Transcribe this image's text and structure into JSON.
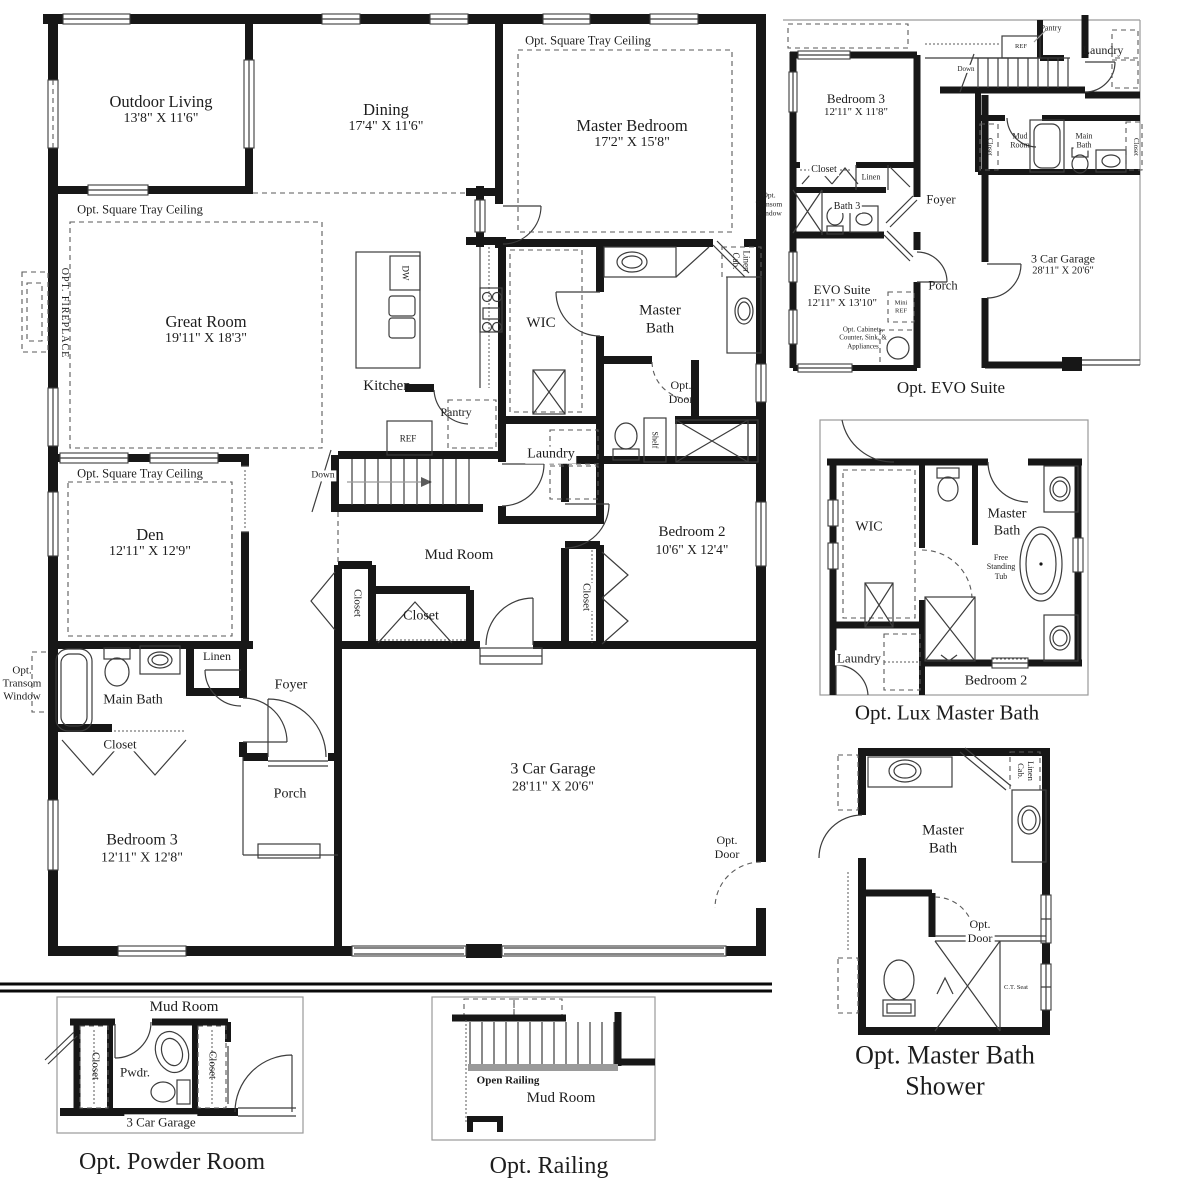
{
  "shared": {
    "closet": "Closet",
    "linen": "Linen",
    "linen_cab": "Linen\nCab.",
    "laundry": "Laundry",
    "mud_room": "Mud Room",
    "mud_room_2l": "Mud\nRoom",
    "main_bath": "Main Bath",
    "main_bath_2l": "Main\nBath",
    "master_bath_2l": "Master\nBath",
    "wic": "WIC",
    "foyer": "Foyer",
    "porch": "Porch",
    "pantry": "Pantry",
    "ref": "REF",
    "dw": "DW",
    "down": "Down",
    "shelf": "Shelf",
    "opt_door": "Opt.\nDoor",
    "opt_transom_window": "Opt.\nTransom\nWindow",
    "opt_square_tray_ceiling": "Opt. Square Tray Ceiling",
    "garage_name": "3 Car Garage",
    "garage_dims": "28'11\" X 20'6\""
  },
  "plans": {
    "main": {
      "rooms": {
        "outdoor_living": {
          "name": "Outdoor Living",
          "dims": "13'8\" X 11'6\""
        },
        "dining": {
          "name": "Dining",
          "dims": "17'4\" X 11'6\""
        },
        "master_bedroom": {
          "name": "Master Bedroom",
          "dims": "17'2\" X 15'8\""
        },
        "great_room": {
          "name": "Great Room",
          "dims": "19'11\" X 18'3\""
        },
        "den": {
          "name": "Den",
          "dims": "12'11\" X 12'9\""
        },
        "bedroom_2": {
          "name": "Bedroom 2",
          "dims": "10'6\" X 12'4\""
        },
        "bedroom_3": {
          "name": "Bedroom 3",
          "dims": "12'11\" X 12'8\""
        },
        "kitchen": "Kitchen"
      },
      "labels": {
        "opt_fireplace": "OPT. FIREPLACE"
      }
    },
    "evo_suite": {
      "caption": "Opt. EVO Suite",
      "rooms": {
        "bedroom_3": {
          "name": "Bedroom 3",
          "dims": "12'11\" X 11'8\""
        },
        "evo_suite": {
          "name": "EVO Suite",
          "dims": "12'11\" X 13'10\""
        },
        "bath_3": "Bath 3"
      },
      "labels": {
        "mini_ref": "Mini\nREF",
        "opt_note": "Opt. Cabinets,\nCounter, Sink, &\nAppliances"
      }
    },
    "lux_master_bath": {
      "caption": "Opt. Lux Master Bath",
      "labels": {
        "free_standing_tub": "Free\nStanding\nTub",
        "bedroom_2": "Bedroom 2"
      }
    },
    "master_bath_shower": {
      "caption": "Opt. Master Bath Shower",
      "labels": {
        "ct_seat": "C.T. Seat"
      }
    },
    "powder_room": {
      "caption": "Opt. Powder Room",
      "labels": {
        "pwdr": "Pwdr."
      }
    },
    "railing": {
      "caption": "Opt. Railing",
      "labels": {
        "open_railing": "Open Railing"
      }
    }
  }
}
